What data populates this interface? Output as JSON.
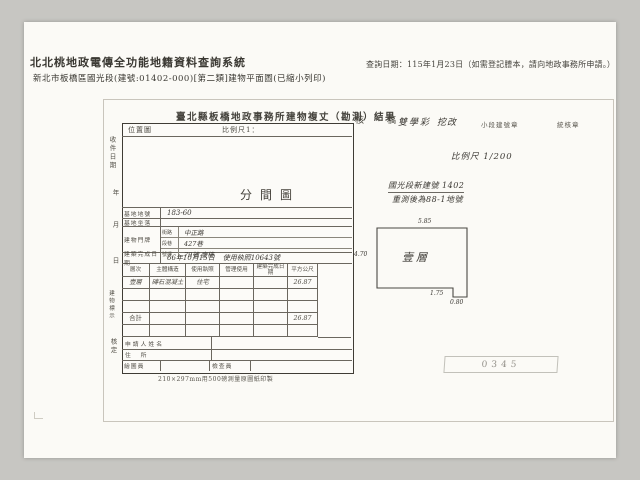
{
  "header": {
    "system_title": "北北桃地政電傳全功能地籍資料查詢系統",
    "subtitle": "新北市板橋區國光段(建號:01402-000)[第二類]建物平面圖(已縮小列印)",
    "query_date": "查詢日期：115年1月23日（如需登記謄本，請向地政事務所申請。）"
  },
  "form": {
    "title": "臺北縣板橋地政事務所建物複丈（勘測）結果",
    "review_label": "核　稿",
    "review_sign1": "雙學彩",
    "review_sign2": "挖改",
    "stamp_small1": "小段建號章",
    "stamp_small2": "統核章",
    "scale_note": "比例尺 1/200",
    "location_label": "位置圖",
    "scale_label": "比例尺1：",
    "plan_label": "分間圖",
    "margin_labels": [
      "收件日期",
      "年",
      "月",
      "日",
      "建物標示",
      "核定"
    ],
    "paper_note": "210×297mm用500磅測量原圖紙印製",
    "serial_stamp": "0345"
  },
  "table": {
    "rows_top": {
      "lot_label": "基地地號",
      "lot_value": "183-60",
      "site_label": "基地坐落",
      "site_value": "",
      "door_label": "建物門牌",
      "door_sub": [
        {
          "k": "街路",
          "v": "中正路"
        },
        {
          "k": "段巷",
          "v": "427巷"
        },
        {
          "k": "號樓",
          "v": "79號 壹樓"
        }
      ],
      "date_label": "建築完成日期",
      "date_value": "66年10月15日",
      "license_value": "使用執照10643號"
    },
    "grid_headers": [
      "層次",
      "主體構造",
      "使用執照",
      "管理使用",
      "建築完成日期",
      "平方公尺"
    ],
    "grid_rows": [
      [
        "壹層",
        "磚石混凝土",
        "住宅",
        "",
        "",
        "26.87"
      ],
      [
        "",
        "",
        "",
        "",
        "",
        ""
      ],
      [
        "",
        "",
        "",
        "",
        "",
        ""
      ],
      [
        "合計",
        "",
        "",
        "",
        "",
        "26.87"
      ],
      [
        "",
        "",
        "",
        "",
        "",
        ""
      ]
    ],
    "applicant_label": "申請人姓名",
    "address_label": "住　所",
    "drafter_label": "繪圖員",
    "checker_label": "檢查員"
  },
  "diagram": {
    "floor_label": "壹層",
    "dim_top": "5.85",
    "dim_left": "4.70",
    "dim_bottom": "1.75",
    "dim_notch": "0.80",
    "note_line1": "國光段新建號 1402",
    "note_line2": "重測後為88-1地號"
  }
}
